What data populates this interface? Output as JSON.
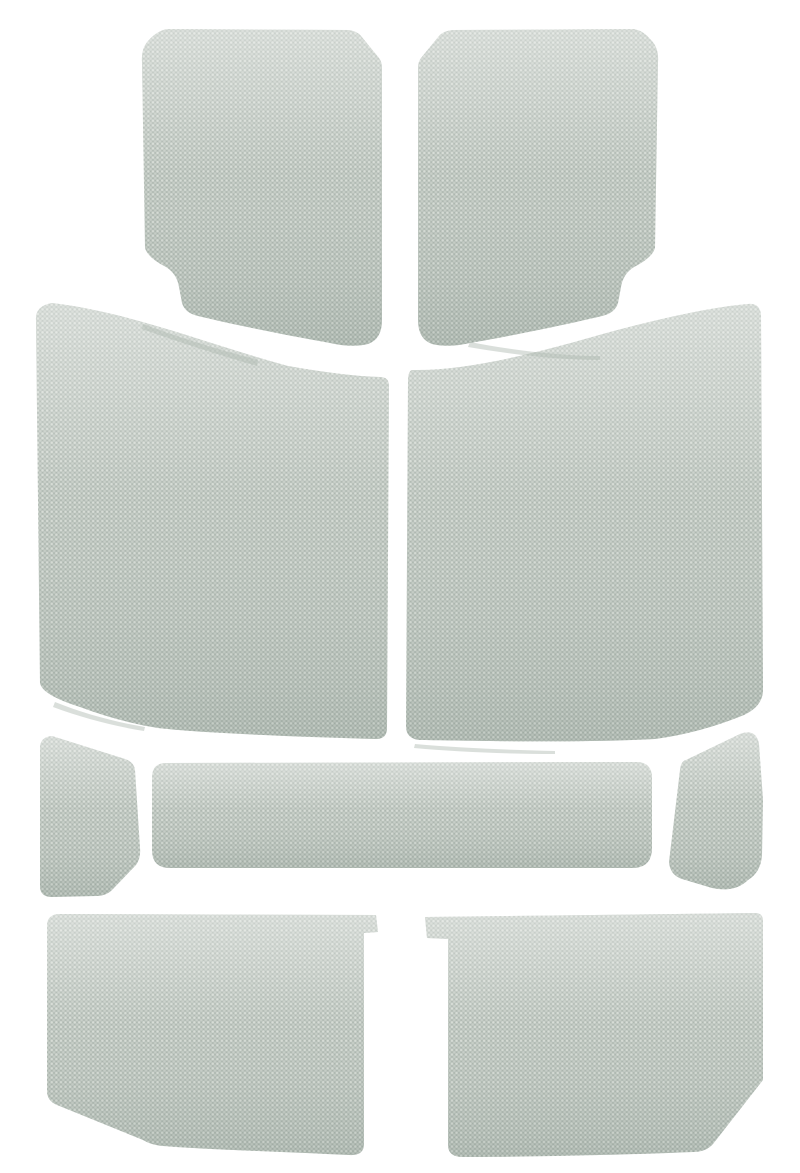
{
  "photo": {
    "subject": "gray-fabric-headliner-kit",
    "piece_count": 9,
    "background_color": "#ffffff"
  },
  "colors": {
    "background": "#ffffff",
    "fabric_base": "#b7c0b9",
    "fabric_light": "#d8ddd6",
    "fabric_light2": "#ccd3cb",
    "fabric_dark": "#a0aba3",
    "shade_top": "#ffffff",
    "shade_bottom": "#71837a",
    "sliver": "#aeb8b0"
  },
  "pieces": [
    {
      "name": "panel-top-left",
      "shape": "rounded panel, notched lower-left, chamfered upper-right"
    },
    {
      "name": "panel-top-right",
      "shape": "rounded panel, notched lower-right, chamfered upper-left (mirror of top-left)"
    },
    {
      "name": "panel-mid-left",
      "shape": "large panel with sloping top edge"
    },
    {
      "name": "panel-mid-right",
      "shape": "large panel with rising top edge (mirror of mid-left)"
    },
    {
      "name": "panel-side-left",
      "shape": "small trapezoid, clipped lower-right corner"
    },
    {
      "name": "panel-center-strip",
      "shape": "long rounded horizontal strip"
    },
    {
      "name": "panel-side-right",
      "shape": "small trapezoid, large rounded upper-right corner"
    },
    {
      "name": "panel-bottom-left",
      "shape": "wide panel, tab at upper-right, clipped lower-left corner"
    },
    {
      "name": "panel-bottom-right",
      "shape": "wide panel, tab at upper-left, clipped lower-right corner"
    }
  ]
}
